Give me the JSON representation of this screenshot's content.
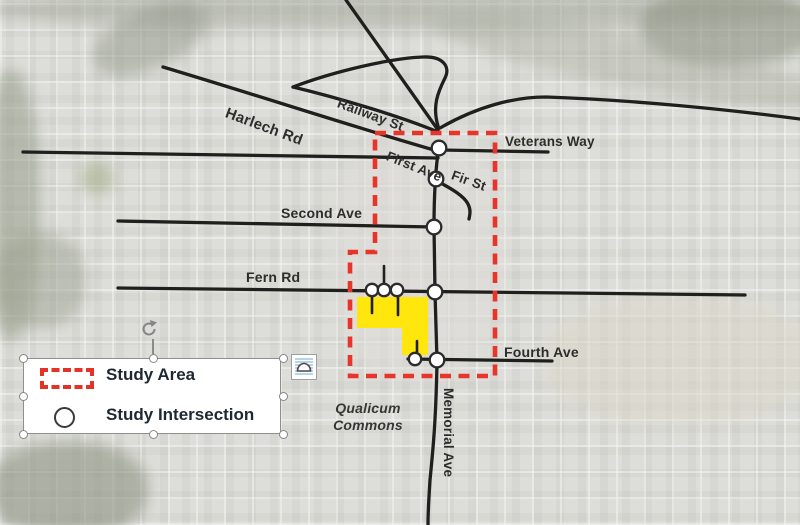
{
  "map": {
    "road_labels": {
      "harlech": "Harlech Rd",
      "railway": "Railway St",
      "first": "First Ave",
      "fir": "Fir St",
      "veterans": "Veterans Way",
      "second": "Second Ave",
      "fern": "Fern Rd",
      "fourth": "Fourth Ave",
      "memorial": "Memorial Ave"
    },
    "area_labels": {
      "qualicum_line1": "Qualicum",
      "qualicum_line2": "Commons"
    }
  },
  "legend": {
    "items": [
      {
        "symbol": "study-area-dashed-rect",
        "label": "Study Area"
      },
      {
        "symbol": "study-intersection-circle",
        "label": "Study Intersection"
      }
    ]
  },
  "colors": {
    "study_area_red": "#e8352b",
    "site_yellow": "#ffe70d",
    "road_black": "#1f1f1d"
  }
}
